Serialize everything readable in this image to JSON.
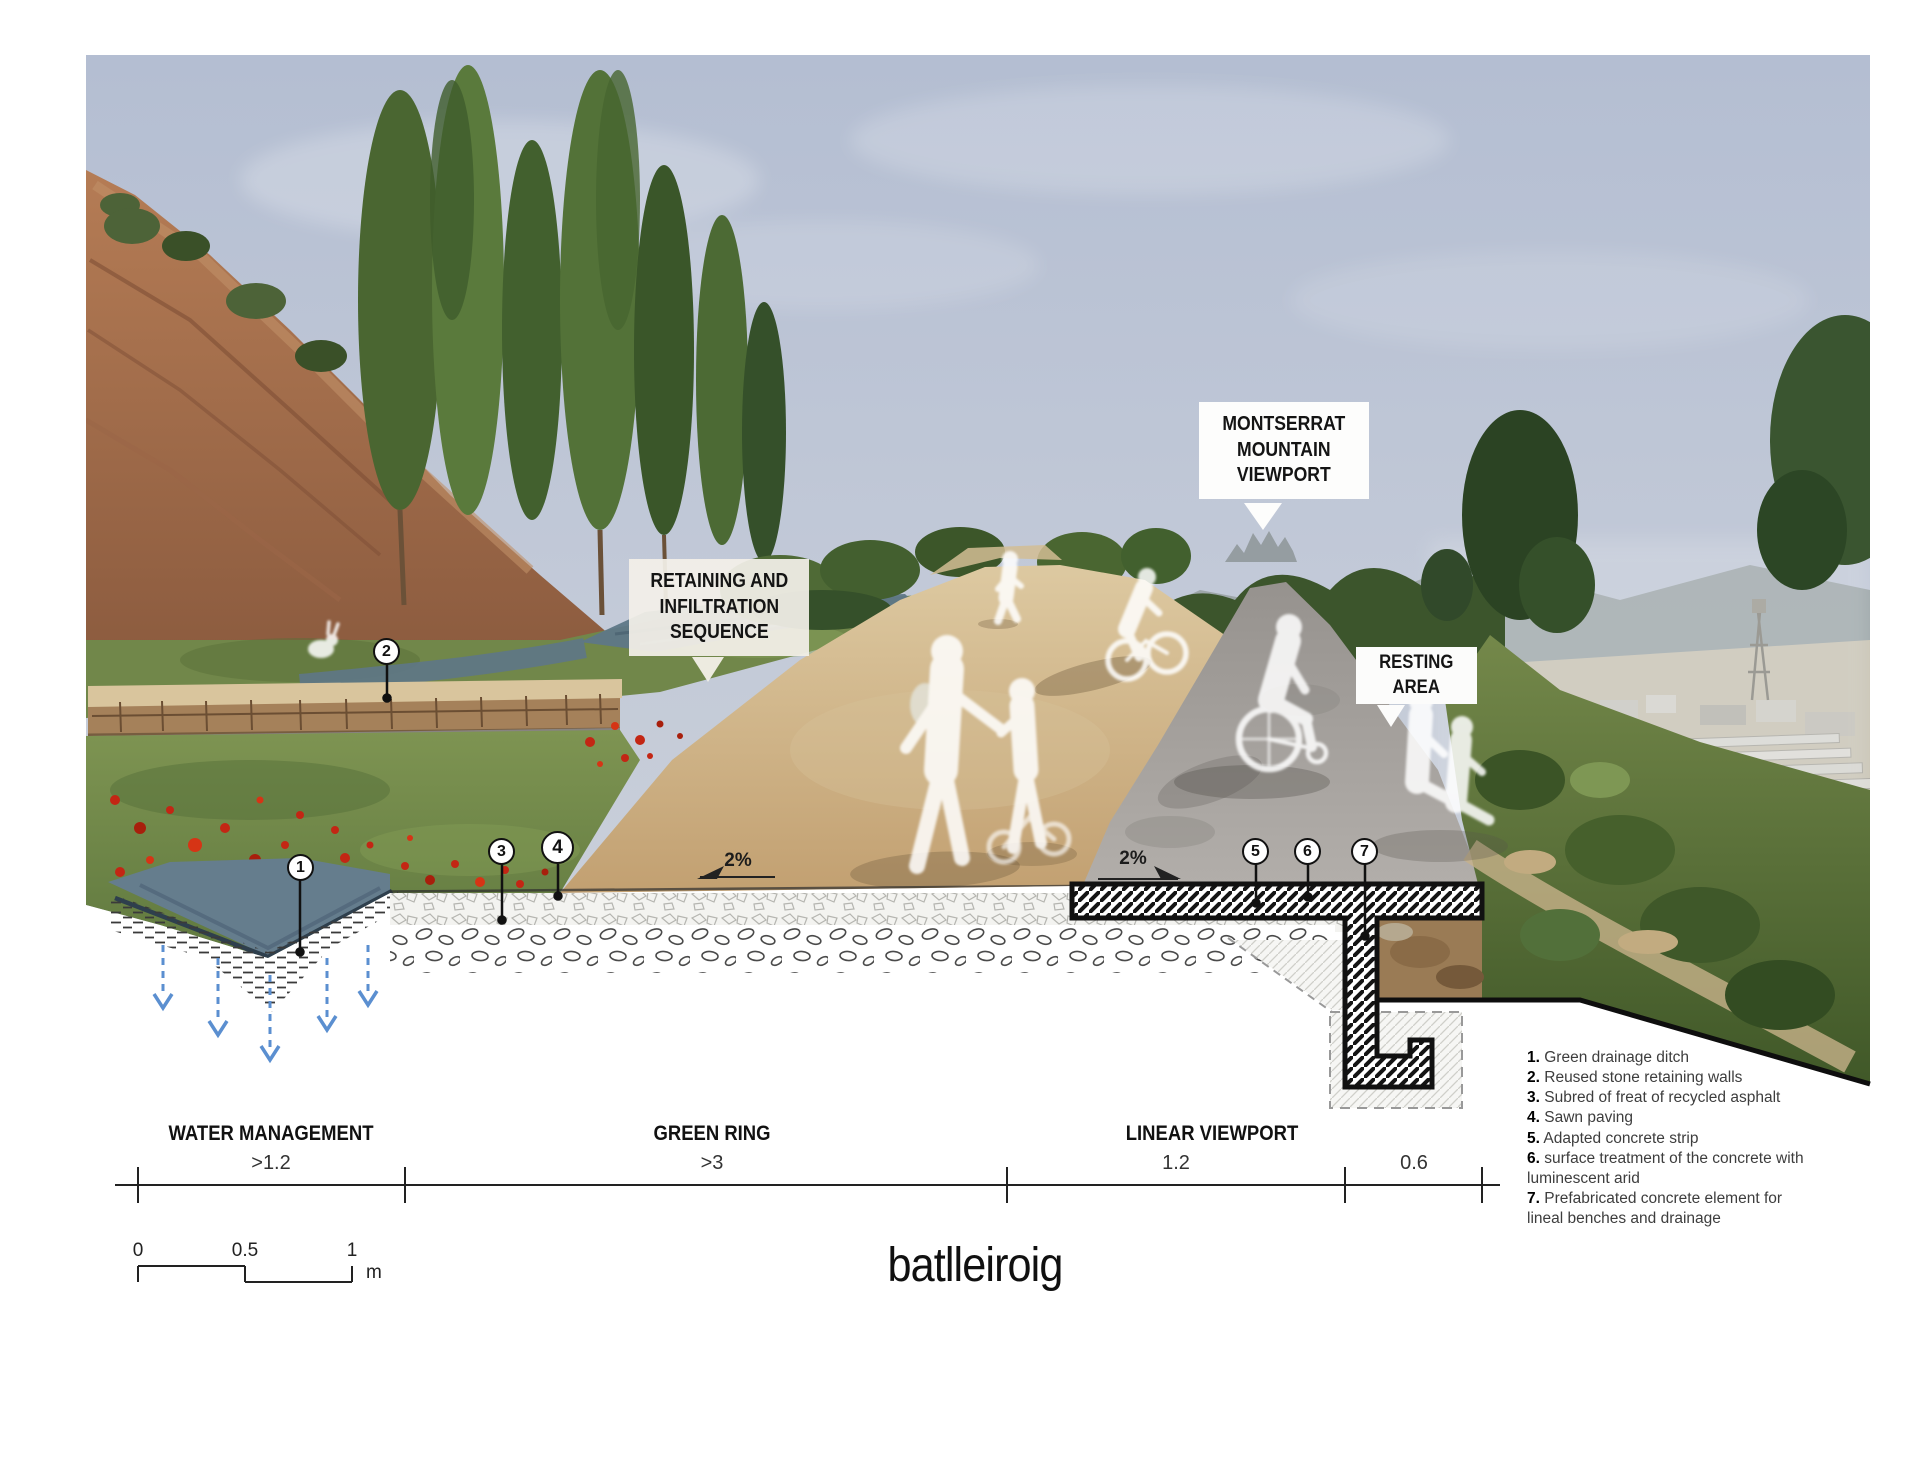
{
  "drawing": {
    "callouts": {
      "montserrat": [
        "MONTSERRAT",
        "MOUNTAIN",
        "VIEWPORT"
      ],
      "retaining": [
        "RETAINING AND",
        "INFILTRATION",
        "SEQUENCE"
      ],
      "resting": [
        "RESTING",
        "AREA"
      ]
    },
    "slopes": [
      "2%",
      "2%"
    ],
    "markers": [
      "1",
      "2",
      "3",
      "4",
      "5",
      "6",
      "7"
    ],
    "dimensions": [
      {
        "name": "WATER MANAGEMENT",
        "value": ">1.2"
      },
      {
        "name": "GREEN RING",
        "value": ">3"
      },
      {
        "name": "LINEAR VIEWPORT",
        "value": "1.2"
      },
      {
        "name": "",
        "value": "0.6"
      }
    ],
    "legend": [
      {
        "num": "1.",
        "text": "Green drainage ditch"
      },
      {
        "num": "2.",
        "text": "Reused stone retaining walls"
      },
      {
        "num": "3.",
        "text": "Subred of freat of recycled asphalt"
      },
      {
        "num": "4.",
        "text": "Sawn paving"
      },
      {
        "num": "5.",
        "text": "Adapted concrete strip"
      },
      {
        "num": "6.",
        "text": "surface treatment of the concrete with luminescent arid"
      },
      {
        "num": "7.",
        "text": "Prefabricated concrete element for lineal benches and drainage"
      }
    ],
    "scale_bar": {
      "ticks": [
        "0",
        "0.5",
        "1"
      ],
      "unit": "m"
    },
    "logo": "batlleiroig",
    "colors": {
      "sky": "#b9c2d3",
      "path_gravel": "#c8a87c",
      "concrete_strip": "#a8a4a0",
      "water": "#5e7787",
      "meadow": "#74894a",
      "poppy": "#c32614",
      "hatch": "#141414",
      "infiltration_arrow": "#5b8fd0"
    }
  }
}
